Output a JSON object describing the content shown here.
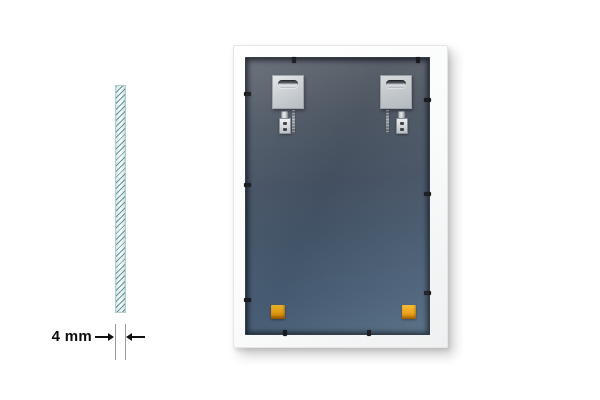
{
  "scene": {
    "background": "#ffffff"
  },
  "dimension": {
    "label": "4 mm",
    "extension_line_color": "#9a9a9a",
    "arrow_color": "#111111",
    "text_color": "#0d0d0d"
  },
  "cross_section": {
    "hatch_line_color": "#3c7d82",
    "fill_color": "#f4fbfb",
    "border_color": "#b5cccc"
  },
  "frame_back": {
    "frame_color": "#fafbfb",
    "panel_top_color": "#666c75",
    "panel_bottom_color": "#50697f",
    "plate_color": "#d3d8dc",
    "slot_dark_color": "#353a41",
    "bumper_color": "#f0a315",
    "tab_color": "#17191d",
    "hanging_plate_count": 2,
    "bumper_count": 2,
    "retaining_tab_count": 10
  }
}
